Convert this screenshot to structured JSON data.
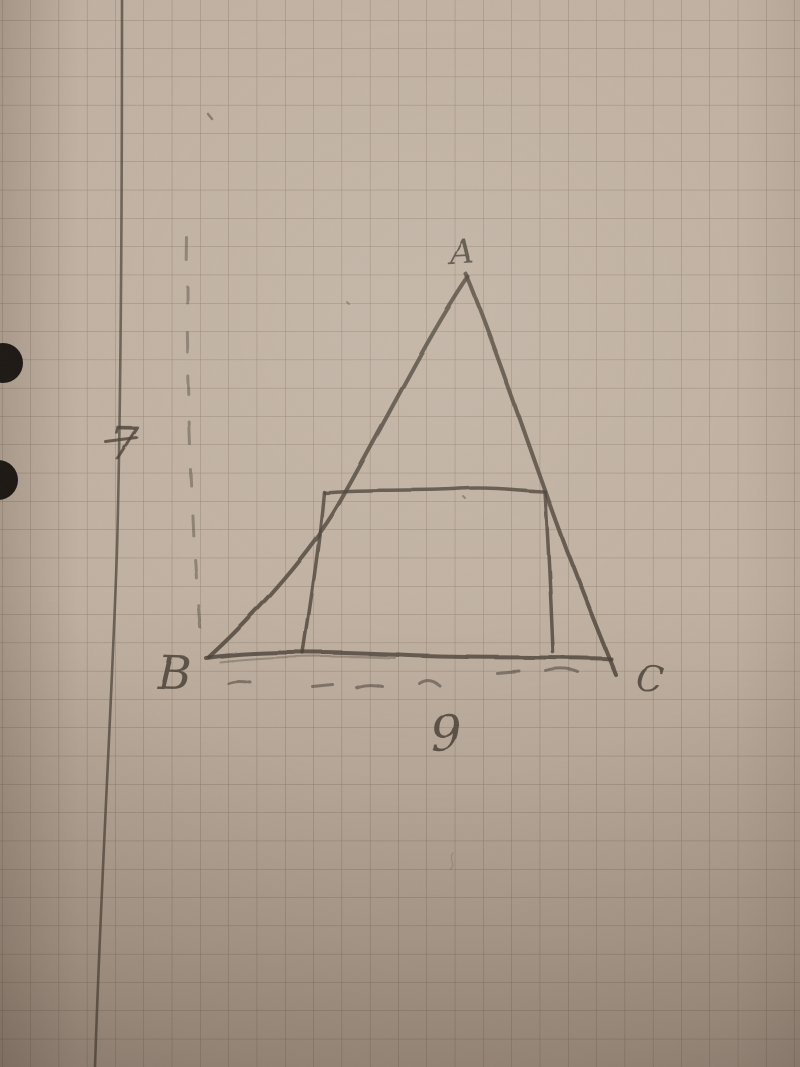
{
  "diagram": {
    "kind": "photo of a hand-drawn pencil geometry sketch on squared graph paper",
    "elements": [
      "triangle ABC",
      "rectangle inscribed inside the triangle sharing the base",
      "dashed vertical guide line left of the triangle",
      "dashed horizontal guide line under the base",
      "ruled vertical margin line",
      "two punched holes on the left edge"
    ],
    "vertex_labels": {
      "apex": "A",
      "bottom_left": "B",
      "bottom_right": "C"
    },
    "measurements": {
      "height": "7",
      "base": "9"
    },
    "colors": {
      "paper": "#c4b5a6",
      "grid_line": "#6f5d4a",
      "margin_line": "#4a4137",
      "pencil": "#463d33",
      "hole_punch": "#0d0b08"
    }
  }
}
